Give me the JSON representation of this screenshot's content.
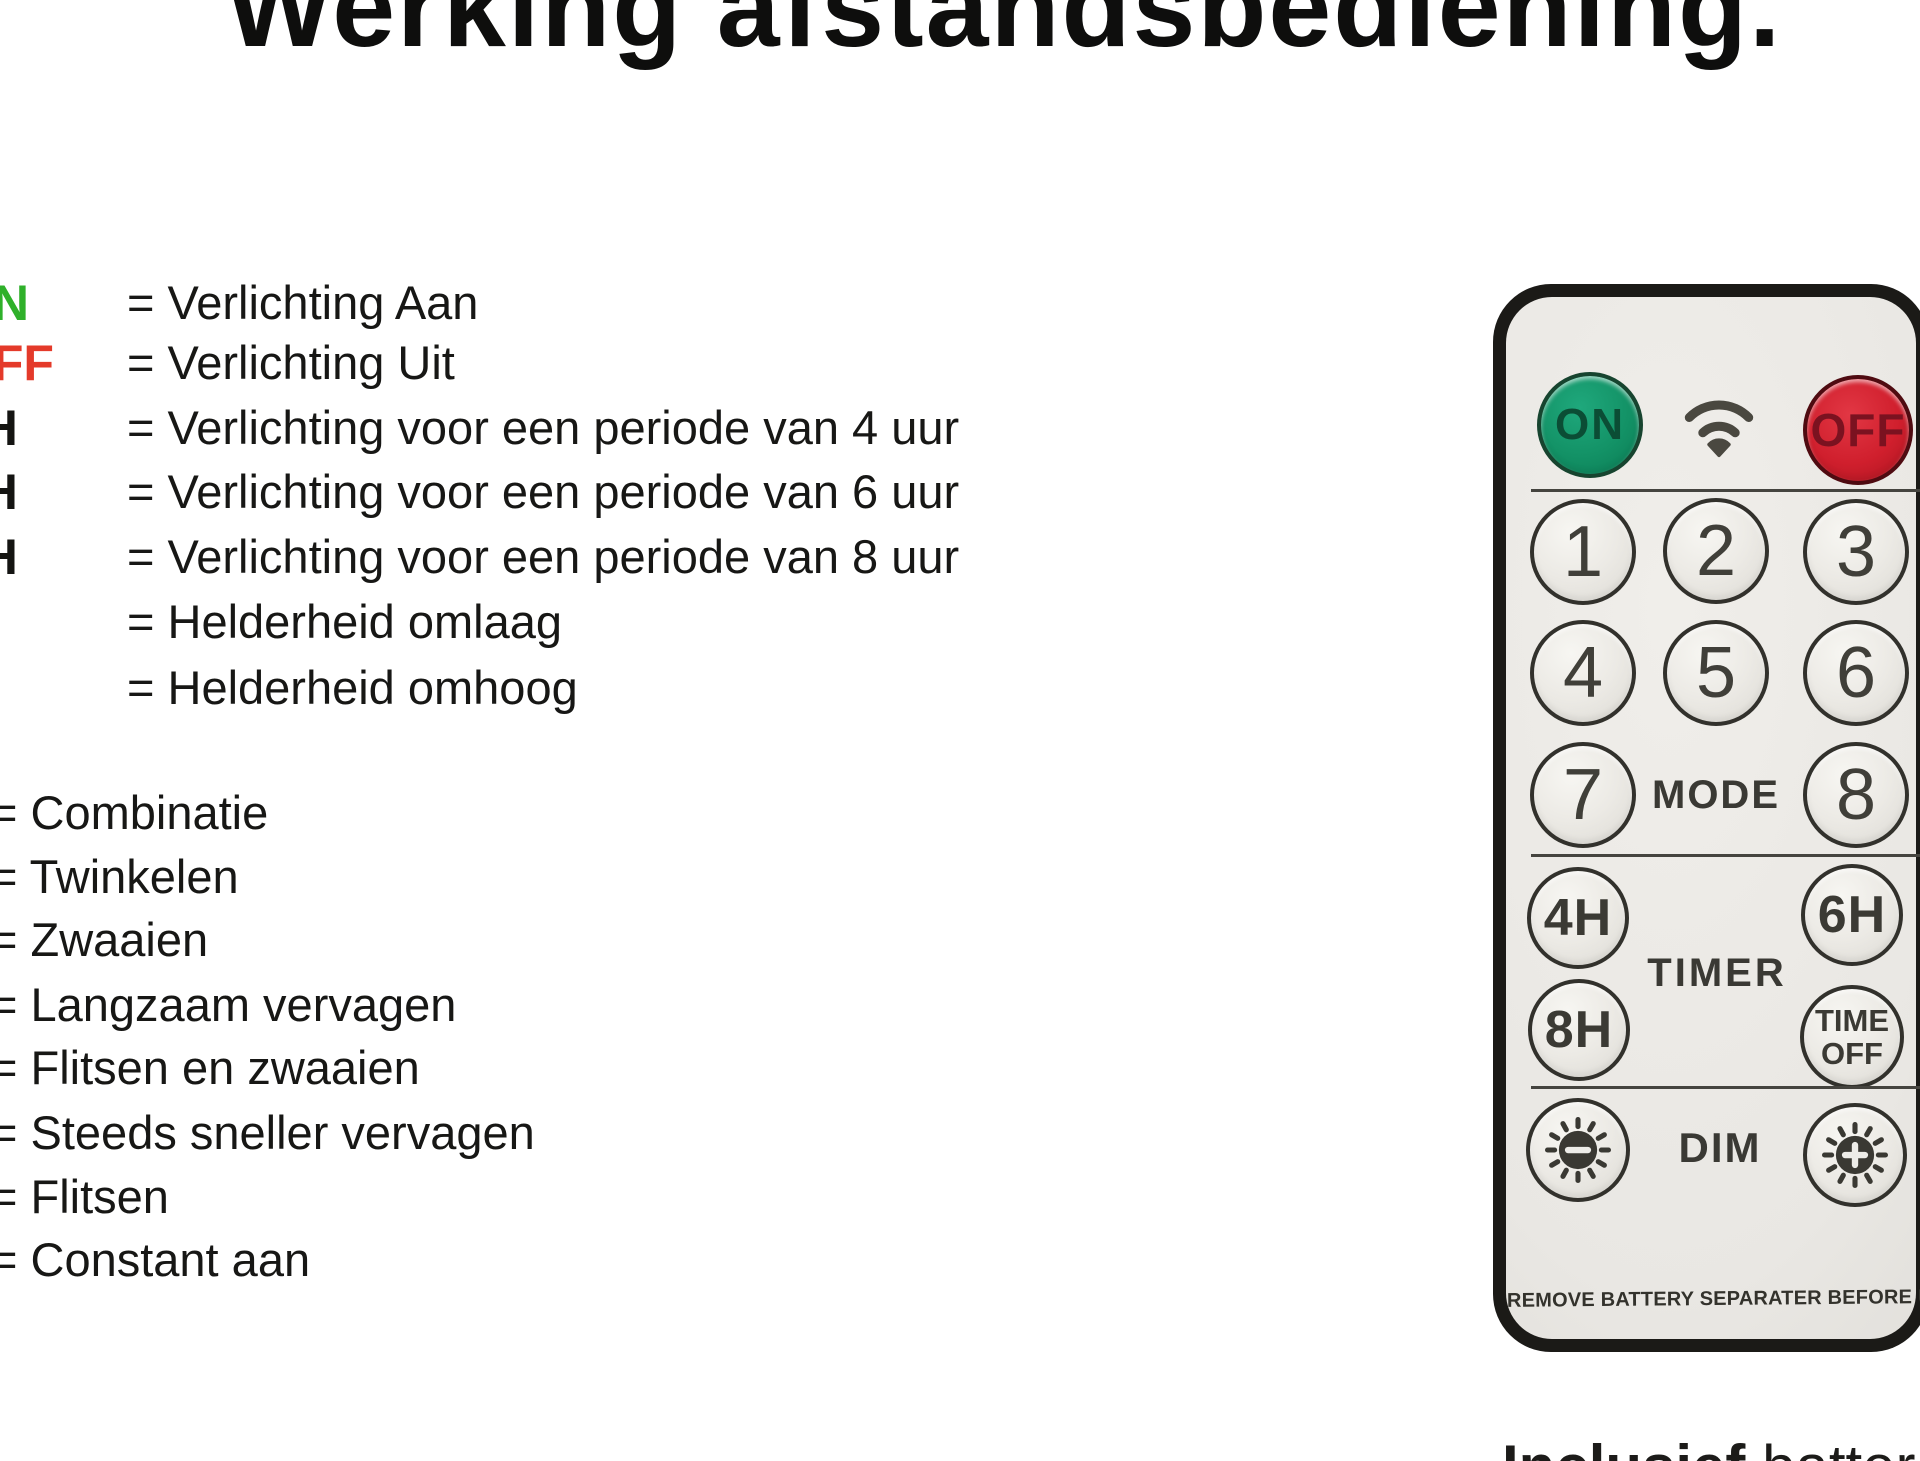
{
  "title": "Werking afstandsbediening.",
  "legend": {
    "group1": [
      {
        "label": "ON",
        "text": "= Verlichting Aan"
      },
      {
        "label": "OFF",
        "text": "= Verlichting Uit"
      },
      {
        "label": "4H",
        "text": "= Verlichting voor een periode van 4 uur"
      },
      {
        "label": "6H",
        "text": "= Verlichting voor een periode van 6 uur"
      },
      {
        "label": "8H",
        "text": "= Verlichting voor een periode van 8 uur"
      },
      {
        "label": "",
        "text": "= Helderheid omlaag"
      },
      {
        "label": "",
        "text": "= Helderheid omhoog"
      }
    ],
    "group2": [
      {
        "text": "= Combinatie"
      },
      {
        "text": "= Twinkelen"
      },
      {
        "text": "= Zwaaien"
      },
      {
        "text": "= Langzaam vervagen"
      },
      {
        "text": "= Flitsen en zwaaien"
      },
      {
        "text": "= Steeds sneller vervagen"
      },
      {
        "text": "= Flitsen"
      },
      {
        "text": "= Constant aan"
      }
    ]
  },
  "remote": {
    "power_on": "ON",
    "power_off": "OFF",
    "digits": [
      "1",
      "2",
      "3",
      "4",
      "5",
      "6",
      "7",
      "8"
    ],
    "mode_label": "MODE",
    "timer_label": "TIMER",
    "timer_4h": "4H",
    "timer_6h": "6H",
    "timer_8h": "8H",
    "time_off_line1": "TIME",
    "time_off_line2": "OFF",
    "dim_label": "DIM",
    "bottom_note": "REMOVE BATTERY SEPARATER BEFORE USE",
    "icons": [
      "wifi-icon",
      "sun-minus-icon",
      "sun-plus-icon"
    ]
  },
  "footer": {
    "bold": "Inclusief",
    "rest": " batter"
  },
  "colors": {
    "legend_on_green": "#2fb02a",
    "legend_off_red": "#e43a2a",
    "button_on_green": "#139266",
    "button_off_red": "#d01f2d",
    "remote_face": "#e9e7e3",
    "remote_border": "#1b1a17"
  }
}
